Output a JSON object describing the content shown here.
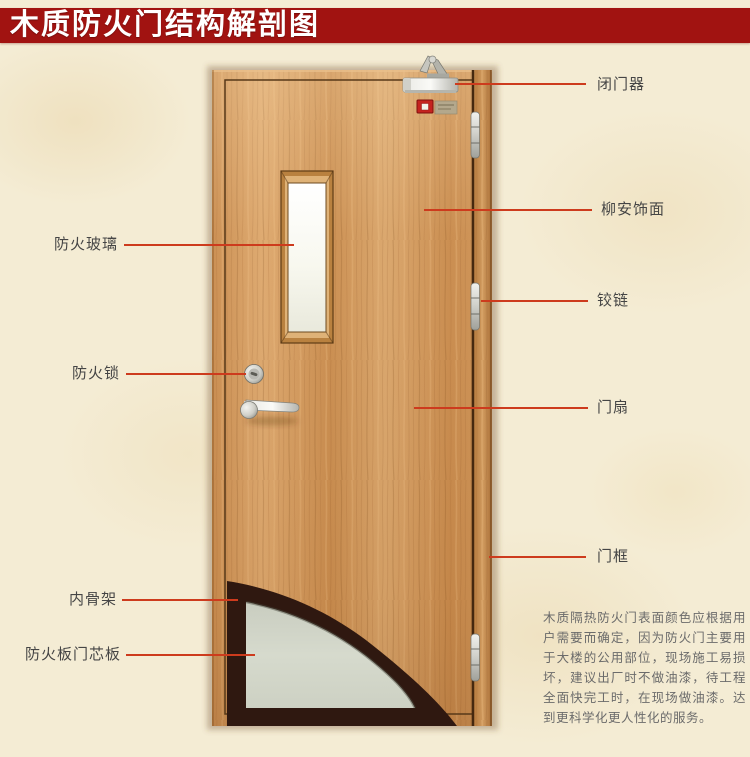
{
  "title": "木质防火门结构解剖图",
  "colors": {
    "banner": "#a11311",
    "background": "#f4ecd4",
    "leader_line": "#cd3b1d",
    "label_text": "#454545",
    "paragraph_text": "#6b6b6b",
    "wood": "#cf9559",
    "door_frame_wood": "#c3874a",
    "skeleton": "#2f1810",
    "core_panel": "#d3d7ca",
    "glass": "#fafaf2",
    "metal": "#d6d6d0"
  },
  "annotations": {
    "left": [
      {
        "id": "fire-glass",
        "label": "防火玻璃"
      },
      {
        "id": "fire-lock",
        "label": "防火锁"
      },
      {
        "id": "inner-skeleton",
        "label": "内骨架"
      },
      {
        "id": "fire-board-core",
        "label": "防火板门芯板"
      }
    ],
    "right": [
      {
        "id": "door-closer",
        "label": "闭门器"
      },
      {
        "id": "lauan-veneer",
        "label": "柳安饰面"
      },
      {
        "id": "hinge",
        "label": "铰链"
      },
      {
        "id": "door-leaf",
        "label": "门扇"
      },
      {
        "id": "door-frame",
        "label": "门框"
      }
    ]
  },
  "description": {
    "text": "木质隔热防火门表面颜色应根据用户需要而确定，因为防火门主要用于大楼的公用部位，现场施工易损坏，建议出厂时不做油漆，待工程全面快完工时，在现场做油漆。达到更科学化更人性化的服务。"
  }
}
